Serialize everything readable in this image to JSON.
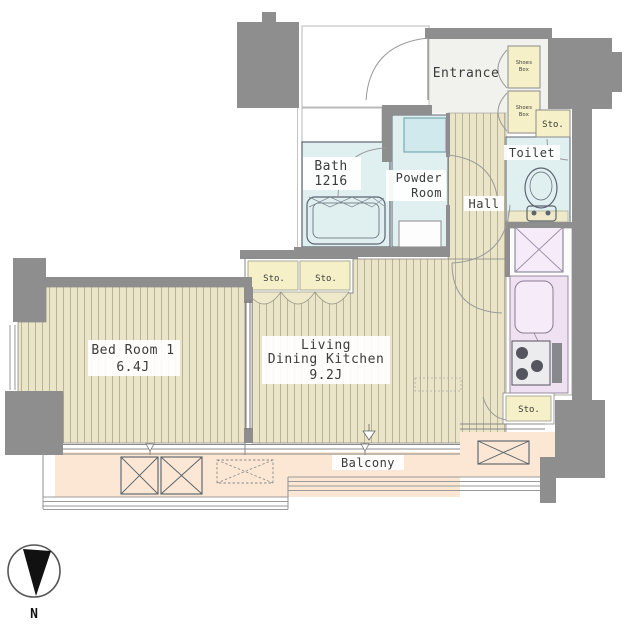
{
  "rooms": {
    "entrance": {
      "label": "Entrance"
    },
    "bath": {
      "name": "Bath",
      "size": "1216"
    },
    "powder_room": {
      "line1": "Powder",
      "line2": "Room"
    },
    "hall": {
      "label": "Hall"
    },
    "toilet": {
      "label": "Toilet"
    },
    "bedroom": {
      "name": "Bed Room 1",
      "area": "6.4J"
    },
    "ldk": {
      "line1": "Living",
      "line2": "Dining Kitchen",
      "area": "9.2J"
    },
    "balcony": {
      "label": "Balcony"
    }
  },
  "storage": {
    "shoes_box_upper": {
      "line1": "Shoes",
      "line2": "Box"
    },
    "shoes_box_lower": {
      "line1": "Shoes",
      "line2": "Box"
    },
    "sto_by_toilet": "Sto.",
    "sto_closet_left": "Sto.",
    "sto_closet_right": "Sto.",
    "sto_kitchen": "Sto."
  },
  "compass": {
    "north_label": "N"
  },
  "colors": {
    "wall": "#8e8e8e",
    "wood_floor": "#eae5c8",
    "wood_stripe": "#b9b295",
    "wet_room": "#e0f0f1",
    "sink_cabinet": "#cfe9ec",
    "fixture_purple": "#efe0f2",
    "fixture_purple_light": "#f6ebf8",
    "storage_yellow": "#f6f0c8",
    "balcony_floor": "#fbe7d3",
    "entrance_floor": "#f1f1ee",
    "toilet_mat": "#efe9c9",
    "scallop": "#efe9cb",
    "corridor": "#ffffff"
  }
}
